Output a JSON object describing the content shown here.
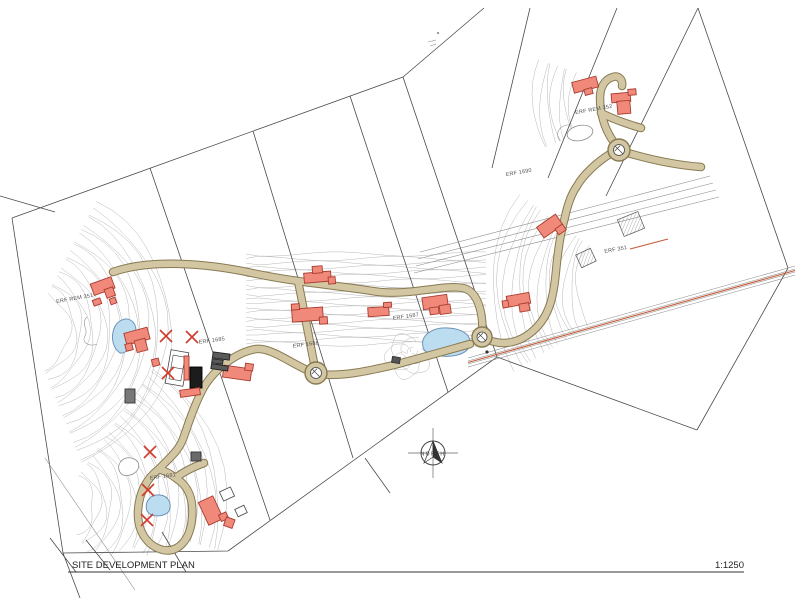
{
  "title": {
    "name": "SITE DEVELOPMENT PLAN",
    "scale": "1:1250"
  },
  "north": {
    "label": "NORTH"
  },
  "colors": {
    "road_fill": "#d3c6a2",
    "road_edge": "#877a52",
    "building": "#f0897a",
    "building_edge": "#a93c30",
    "water": "#bcdcf0",
    "water_edge": "#6b93b8",
    "x_mark": "#d23a2e",
    "servitude": "#c75b3a"
  },
  "labels": [
    {
      "text": "ERF REM 351",
      "x": 75,
      "y": 300,
      "rot": -10
    },
    {
      "text": "ERF 1685",
      "x": 212,
      "y": 342,
      "rot": -8
    },
    {
      "text": "ERF 1686",
      "x": 306,
      "y": 346,
      "rot": -8
    },
    {
      "text": "ERF 1687",
      "x": 406,
      "y": 318,
      "rot": -8
    },
    {
      "text": "ERF 1681",
      "x": 163,
      "y": 478,
      "rot": -8
    },
    {
      "text": "ERF 1690",
      "x": 519,
      "y": 174,
      "rot": -10
    },
    {
      "text": "ERF REM 352",
      "x": 594,
      "y": 111,
      "rot": -10
    },
    {
      "text": "ERF 351",
      "x": 616,
      "y": 251,
      "rot": -10
    }
  ],
  "buildings": [
    {
      "x": 103,
      "y": 287,
      "r": -20,
      "parts": [
        [
          -11,
          -7,
          22,
          12
        ],
        [
          0,
          3,
          9,
          9
        ]
      ]
    },
    {
      "x": 97,
      "y": 302,
      "r": -20,
      "parts": [
        [
          -4,
          -3,
          8,
          6
        ]
      ]
    },
    {
      "x": 113,
      "y": 301,
      "r": -20,
      "parts": [
        [
          -3,
          -3,
          6,
          6
        ]
      ]
    },
    {
      "x": 138,
      "y": 340,
      "r": -15,
      "parts": [
        [
          -12,
          -10,
          24,
          12
        ],
        [
          -4,
          0,
          11,
          12
        ],
        [
          -14,
          1,
          7,
          7
        ]
      ]
    },
    {
      "x": 155,
      "y": 362,
      "r": -15,
      "parts": [
        [
          -3,
          -3,
          7,
          7
        ]
      ]
    },
    {
      "x": 237,
      "y": 374,
      "r": 8,
      "parts": [
        [
          -14,
          -7,
          28,
          12
        ],
        [
          7,
          -12,
          8,
          7
        ]
      ]
    },
    {
      "x": 221,
      "y": 361,
      "r": 8,
      "fill": "#5a5a5a",
      "stroke": "#222222",
      "parts": [
        [
          -9,
          -8,
          17,
          6
        ],
        [
          -9,
          -1,
          11,
          4
        ],
        [
          -9,
          4,
          17,
          5
        ]
      ]
    },
    {
      "x": 319,
      "y": 277,
      "r": -5,
      "parts": [
        [
          -15,
          -5,
          27,
          10
        ],
        [
          -6,
          -11,
          10,
          7
        ],
        [
          9,
          1,
          7,
          7
        ]
      ]
    },
    {
      "x": 308,
      "y": 315,
      "r": -4,
      "parts": [
        [
          -16,
          -7,
          31,
          13
        ],
        [
          -16,
          -12,
          8,
          6
        ],
        [
          11,
          3,
          8,
          7
        ]
      ]
    },
    {
      "x": 379,
      "y": 312,
      "r": -4,
      "parts": [
        [
          -11,
          -5,
          21,
          9
        ],
        [
          5,
          -9,
          8,
          5
        ]
      ]
    },
    {
      "x": 436,
      "y": 305,
      "r": -8,
      "parts": [
        [
          -13,
          -9,
          25,
          12
        ],
        [
          3,
          1,
          11,
          9
        ],
        [
          -7,
          2,
          9,
          7
        ]
      ]
    },
    {
      "x": 551,
      "y": 227,
      "r": -35,
      "parts": [
        [
          -12,
          -8,
          23,
          13
        ],
        [
          2,
          4,
          9,
          7
        ]
      ]
    },
    {
      "x": 520,
      "y": 300,
      "r": -10,
      "parts": [
        [
          -13,
          -6,
          23,
          11
        ],
        [
          -2,
          4,
          10,
          8
        ],
        [
          -18,
          -2,
          6,
          7
        ]
      ]
    },
    {
      "x": 586,
      "y": 86,
      "r": -15,
      "parts": [
        [
          -13,
          -7,
          25,
          11
        ],
        [
          -3,
          3,
          8,
          6
        ]
      ]
    },
    {
      "x": 622,
      "y": 104,
      "r": -5,
      "parts": [
        [
          -10,
          -11,
          19,
          9
        ],
        [
          -5,
          -3,
          13,
          13
        ],
        [
          7,
          -14,
          8,
          6
        ]
      ]
    },
    {
      "x": 211,
      "y": 511,
      "r": -25,
      "parts": [
        [
          -8,
          -13,
          16,
          25
        ],
        [
          5,
          7,
          8,
          7
        ]
      ]
    },
    {
      "x": 229,
      "y": 522,
      "r": 20,
      "parts": [
        [
          -4,
          -4,
          9,
          9
        ]
      ]
    },
    {
      "x": 196,
      "y": 457,
      "r": 0,
      "fill": "#6a6a6a",
      "stroke": "#333333",
      "parts": [
        [
          -5,
          -5,
          10,
          9
        ]
      ]
    },
    {
      "x": 130,
      "y": 396,
      "r": 0,
      "fill": "#787878",
      "stroke": "#333333",
      "parts": [
        [
          -5,
          -7,
          10,
          14
        ]
      ]
    },
    {
      "x": 196,
      "y": 377,
      "r": 0,
      "fill": "#1c1c1c",
      "stroke": "#000000",
      "parts": [
        [
          -6,
          -10,
          12,
          21
        ]
      ]
    },
    {
      "x": 186,
      "y": 368,
      "r": 0,
      "parts": [
        [
          -2,
          -12,
          5,
          24
        ]
      ]
    },
    {
      "x": 190,
      "y": 392,
      "r": -8,
      "parts": [
        [
          -10,
          -3,
          20,
          7
        ]
      ]
    },
    {
      "x": 227,
      "y": 494,
      "r": -25,
      "fill": "#ffffff",
      "stroke": "#555555",
      "parts": [
        [
          -6,
          -5,
          12,
          10
        ]
      ]
    },
    {
      "x": 241,
      "y": 511,
      "r": -25,
      "fill": "#ffffff",
      "stroke": "#555555",
      "parts": [
        [
          -5,
          -4,
          10,
          8
        ]
      ]
    },
    {
      "x": 396,
      "y": 360,
      "r": 10,
      "fill": "#555555",
      "stroke": "#333333",
      "parts": [
        [
          -4,
          -3,
          8,
          6
        ]
      ]
    }
  ],
  "x_marks": [
    [
      166,
      336
    ],
    [
      192,
      337
    ],
    [
      168,
      373
    ],
    [
      150,
      452
    ],
    [
      148,
      490
    ],
    [
      147,
      520
    ]
  ],
  "roundabouts": [
    [
      316,
      373,
      11
    ],
    [
      482,
      337,
      10
    ],
    [
      619,
      150,
      11
    ]
  ]
}
